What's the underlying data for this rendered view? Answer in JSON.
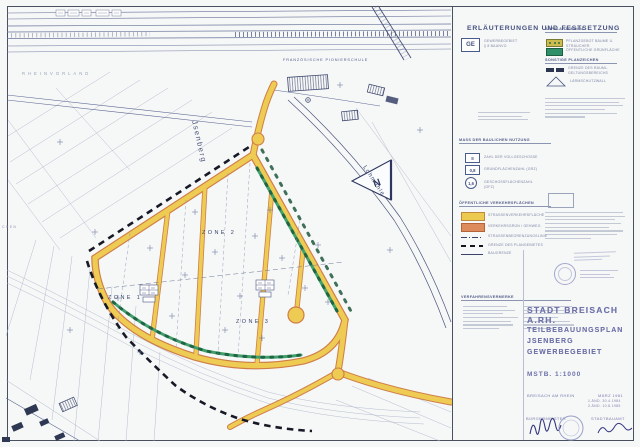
{
  "legend": {
    "title": "ERLÄUTERUNGEN UND FESTSETZUNG",
    "ge": {
      "code": "GE",
      "line1": "GEWERBEGEBIET",
      "line2": "§ 8 BAUNVO"
    },
    "use_section": {
      "header": "MASS DER BAULICHEN NUTZUNG",
      "items": [
        {
          "symbol": "II",
          "label": "ZAHL DER VOLLGESCHOSSE"
        },
        {
          "symbol": "0,8",
          "label": "GRUNDFLÄCHENZAHL (GRZ)"
        },
        {
          "symbol": "1,6",
          "label": "GESCHOSSFLÄCHENZAHL (GFZ)"
        }
      ]
    },
    "traffic_section": {
      "header": "ÖFFENTLICHE VERKEHRSFLÄCHEN",
      "items": [
        {
          "swatch": "yellow",
          "label": "STRASSENVERKEHRSFLÄCHE"
        },
        {
          "swatch": "orange",
          "label": "VERKEHRSGRÜN / GEHWEG"
        },
        {
          "swatch": "dashdot-line",
          "label": "STRASSENBEGRENZUNGSLINIE"
        },
        {
          "swatch": "dashed-line",
          "label": "GRENZE DES PLANGEBIETES"
        },
        {
          "swatch": "solid-line",
          "label": "BAUGRENZE"
        }
      ]
    },
    "planting_section": {
      "header": "ANPFLANZUNGEN",
      "items": [
        {
          "swatch": "olive",
          "label": "PFLANZGEBOT BÄUME U. STRÄUCHER"
        },
        {
          "swatch": "teal",
          "label": "ÖFFENTLICHE GRÜNFLÄCHE"
        }
      ]
    },
    "misc_section": {
      "header": "SONSTIGE PLANZEICHEN",
      "items": [
        {
          "swatch": "navy-pair",
          "label": "GRENZE DES RÄUML. GELTUNGSBEREICHS"
        },
        {
          "swatch": "triangle",
          "label": "LÄRMSCHUTZWALL"
        }
      ]
    },
    "procedure_header": "VERFAHRENSVERMERKE"
  },
  "map": {
    "labels": {
      "area_top": "RHEINVORLAND",
      "school": "FRANZÖSISCHE  PIONIERSCHULE",
      "hill": "Jsenberg",
      "road": "Lohmühle",
      "zone1": "ZONE 1",
      "zone2": "ZONE 2",
      "zone3": "ZONE 3",
      "north": "N",
      "edge_fragment": "CHEN"
    }
  },
  "title_block": {
    "city": "STADT BREISACH A.RH.",
    "plan_type": "TEILBEBAUUNGSPLAN",
    "plan_area": "JSENBERG",
    "plan_use": "GEWERBEGEBIET",
    "scale": "MSTB.  1:1000",
    "place": "BREISACH AM RHEIN",
    "date": "MÄRZ 1981",
    "amendment1": "1.ÄND.  30.4.1984",
    "amendment2": "2.ÄND.  10.8.1985",
    "sig_left": "BÜRGERMEISTER",
    "sig_right": "STADTBAUAMT"
  },
  "colors": {
    "road_fill": "#eecb52",
    "road_edge": "#cf7d48",
    "green_strip": "#3f9a68",
    "boundary": "#171a26",
    "map_ink": "#39436b",
    "title_ink": "#6e72a8",
    "paper": "#f6f7f7"
  }
}
